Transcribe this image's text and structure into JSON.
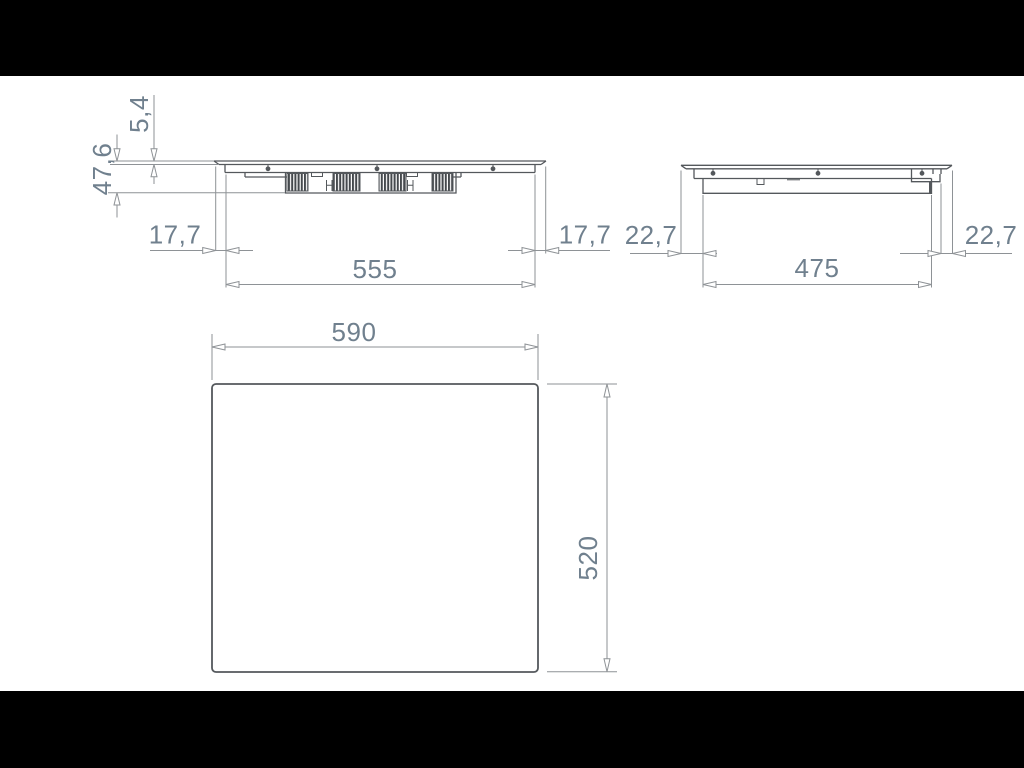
{
  "document": {
    "kind": "technical-dimension-drawing",
    "views": {
      "front": {
        "labels": {
          "glass_thickness": "5,4",
          "overall_height": "47,6",
          "overhang_left": "17,7",
          "overhang_right": "17,7",
          "body_width": "555"
        }
      },
      "side": {
        "labels": {
          "overhang_left": "22,7",
          "overhang_right": "22,7",
          "body_depth": "475"
        }
      },
      "top": {
        "labels": {
          "overall_width": "590",
          "overall_depth": "520"
        }
      }
    }
  },
  "colors": {
    "letterbox": "#000000",
    "sheet": "#ffffff",
    "part_line": "#54585c",
    "detail_fill": "#45494d",
    "dim_line": "#8e9296",
    "label_text": "#70808e"
  }
}
